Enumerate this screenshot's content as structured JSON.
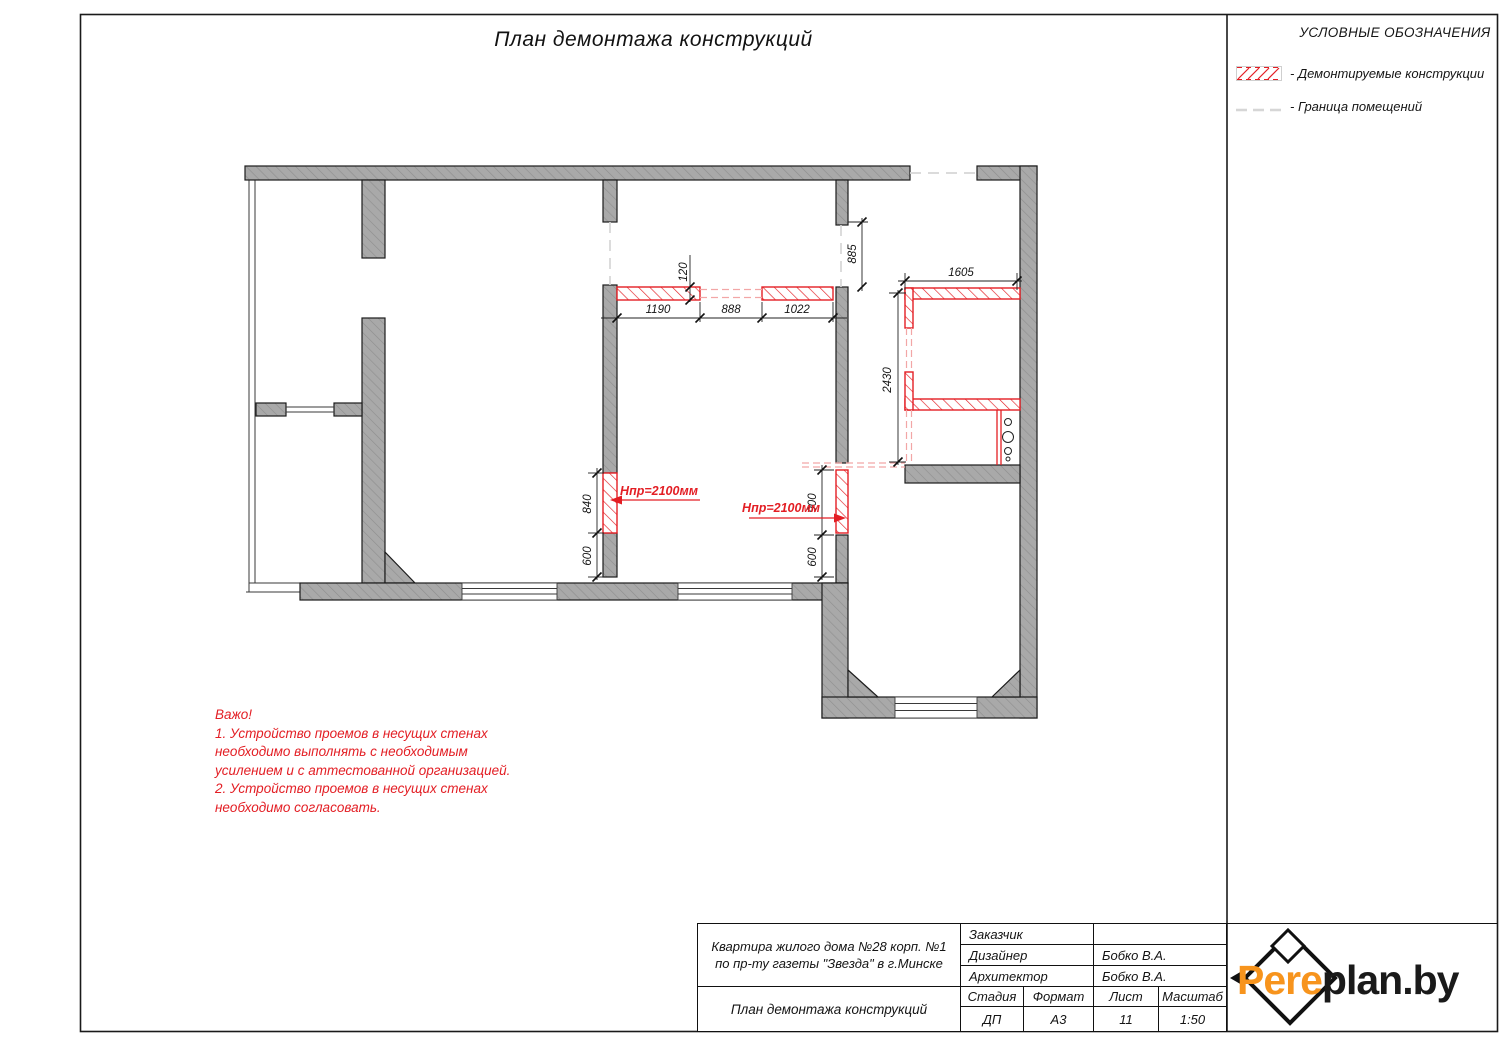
{
  "title": "План демонтажа конструкций",
  "legend": {
    "header": "УСЛОВНЫЕ ОБОЗНАЧЕНИЯ",
    "demolished_label": "- Демонтируемые конструкции",
    "boundary_label": "- Граница помещений"
  },
  "notes": {
    "lines": [
      "Важо!",
      "1. Устройство проемов в несущих стенах",
      "необходимо выполнять с необходимым",
      "усилением и с аттестованной организацией.",
      "2. Устройство проемов в несущих стенах",
      "необходимо согласовать."
    ]
  },
  "plan": {
    "dims": {
      "seg1": "1190",
      "seg2": "888",
      "seg3": "1022",
      "wall_thk": "120",
      "offset_top": "885",
      "kitchen_w": "1605",
      "kitchen_h": "2430",
      "opening_left_h": "840",
      "opening_left_off": "600",
      "opening_right_h": "900",
      "opening_right_off": "600"
    },
    "opening_note_left": "Нпр=2100мм",
    "opening_note_right": "Нпр=2100мм"
  },
  "titleblock": {
    "project_line1": "Квартира  жилого дома №28 корп. №1",
    "project_line2": "по пр-ту газеты \"Звезда\" в г.Минске",
    "drawing_title": "План демонтажа конструкций",
    "rows": [
      {
        "label": "Заказчик",
        "value": ""
      },
      {
        "label": "Дизайнер",
        "value": "Бобко В.А."
      },
      {
        "label": "Архитектор",
        "value": "Бобко В.А."
      }
    ],
    "cols": [
      {
        "label": "Стадия",
        "value": "ДП"
      },
      {
        "label": "Формат",
        "value": "А3"
      },
      {
        "label": "Лист",
        "value": "11"
      },
      {
        "label": "Масштаб",
        "value": "1:50"
      }
    ]
  },
  "logo": {
    "part1": "Pere",
    "part2": "plan.by"
  },
  "colors": {
    "demolition_red": "#e31e24",
    "dashed_red": "#f2a6a6",
    "wall_gray": "#a9a9a9",
    "boundary_gray": "#d6d6d6",
    "logo_orange": "#F7941D"
  }
}
